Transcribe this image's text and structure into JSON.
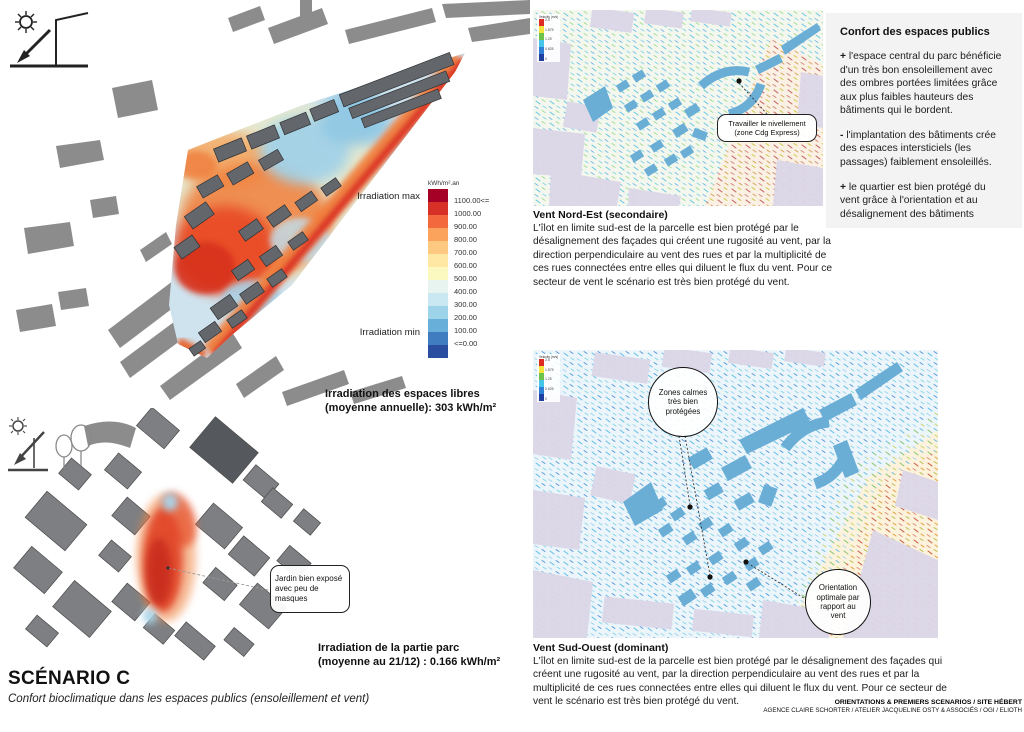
{
  "page": {
    "title": "SCÉNARIO C",
    "subtitle": "Confort bioclimatique dans les espaces publics (ensoleillement et vent)",
    "credits_line1": "ORIENTATIONS & PREMIERS SCENARIOS / SITE HÉBERT",
    "credits_line2": "AGENCE CLAIRE SCHORTER / ATELIER JACQUELINE OSTY & ASSOCIÉS / OGI / ELIOTH"
  },
  "icons": {
    "sun_diagram": "sun-shadow-arrow-diagram",
    "sun_trees_diagram": "sun-shadow-trees-diagram"
  },
  "irradiation_map": {
    "caption_line1": "Irradiation des espaces libres",
    "caption_line2": "(moyenne annuelle): 303 kWh/m²",
    "legend": {
      "unit": "kWh/m².an",
      "max_label": "Irradiation max",
      "min_label": "Irradiation min",
      "steps": [
        {
          "label": "1100.00<=",
          "color": "#a50026"
        },
        {
          "label": "1000.00",
          "color": "#d73027"
        },
        {
          "label": "900.00",
          "color": "#f4683e"
        },
        {
          "label": "800.00",
          "color": "#fba35d"
        },
        {
          "label": "700.00",
          "color": "#fdc980"
        },
        {
          "label": "600.00",
          "color": "#fee8a4"
        },
        {
          "label": "500.00",
          "color": "#fbf8c0"
        },
        {
          "label": "400.00",
          "color": "#e7f4ef"
        },
        {
          "label": "300.00",
          "color": "#c9e8f2"
        },
        {
          "label": "200.00",
          "color": "#9ed4ea"
        },
        {
          "label": "100.00",
          "color": "#68b0da"
        },
        {
          "label": "<=0.00",
          "color": "#3f7cc0"
        },
        {
          "label": "",
          "color": "#2a4da0"
        }
      ]
    }
  },
  "parc_map": {
    "caption_line1": "Irradiation de la partie parc",
    "caption_line2": "(moyenne au 21/12) : 0.166 kWh/m²",
    "callout": "Jardin bien exposé avec peu de masques"
  },
  "wind_legend": {
    "title": "Velocity (m/s)",
    "values": [
      "2.5",
      "1.875",
      "1.25",
      "0.625",
      "0"
    ],
    "colors": [
      "#dd2c23",
      "#f2e43b",
      "#6cc24a",
      "#45c6e8",
      "#2f7fd6",
      "#1f3f9e"
    ]
  },
  "wind_ne": {
    "heading": "Vent Nord-Est (secondaire)",
    "body": "L'îlot en limite sud-est de la parcelle est bien protégé par le désalignement des façades qui créent une rugosité au vent, par la direction perpendiculaire au vent des rues et par la multiplicité de ces rues connectées entre elles qui diluent le flux du vent. Pour ce secteur de vent le scénario est très bien protégé du vent.",
    "callout": "Travailler le nivellement (zone Cdg Express)"
  },
  "wind_sw": {
    "heading": "Vent Sud-Ouest (dominant)",
    "body": "L'îlot en limite sud-est de la parcelle est bien protégé par le désalignement des façades qui créent une rugosité au vent, par la direction perpendiculaire au vent des rues et par la multiplicité de ces rues connectées entre elles qui diluent le flux du vent. Pour ce secteur de vent le scénario est très bien protégé du vent.",
    "callout_zones": "Zones calmes très bien protégées",
    "callout_orientation": "Orientation optimale par rapport au vent"
  },
  "sidebar": {
    "heading": "Confort des espaces publics",
    "items": [
      {
        "sign": "+",
        "text": "l'espace central du parc bénéficie d'un très bon ensoleillement avec des ombres portées limitées grâce aux plus faibles hauteurs des bâtiments qui le bordent."
      },
      {
        "sign": "-",
        "text": "l'implantation des bâtiments crée des espaces intersticiels (les passages) faiblement ensoleillés."
      },
      {
        "sign": "+",
        "text": "le quartier est bien protégé du vent grâce à l'orientation et au désalignement des bâtiments"
      }
    ]
  },
  "colors": {
    "site_buildings_dark": "#63676c",
    "context_gray": "#8c8c8c",
    "wind_site_blue": "#6aaed6",
    "wind_context_lavender": "#dcd7e8",
    "heat_red": "#d92f20",
    "heat_orange": "#f07f3c",
    "cool_blue": "#9fd0e8"
  }
}
